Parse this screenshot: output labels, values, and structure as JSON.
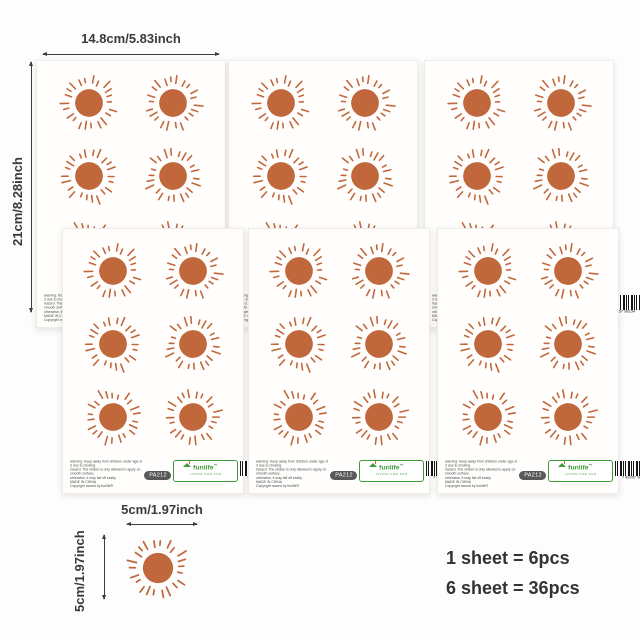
{
  "dimensions": {
    "sheet_width": "14.8cm/5.83inch",
    "sheet_height": "21cm/8.28inch",
    "sticker_width": "5cm/1.97inch",
    "sticker_height": "5cm/1.97inch"
  },
  "info": {
    "line1": "1 sheet = 6pcs",
    "line2": "6 sheet = 36pcs"
  },
  "sheet": {
    "warning": [
      "warning: Keep away from children under age of 3 due to choking",
      "hazard. The sticker is only allowed to apply on smooth surface,",
      "otherwise, it may fall off easily.",
      "MADE IN CHINA",
      "Copyright owned by funlife®"
    ],
    "badge": "PA212",
    "logo": {
      "brand": "funlife",
      "tm": "™",
      "tagline": "LIVING FOR FUN"
    },
    "barcode_number": "7 42057 98234"
  },
  "counts": {
    "sheets": 6,
    "stickers_per_sheet": 6,
    "total_stickers": 36
  },
  "colors": {
    "sun": "#c1673c",
    "logo_green": "#3f9a37",
    "badge_bg": "#57585a",
    "dim_text": "#3a3a3a"
  }
}
